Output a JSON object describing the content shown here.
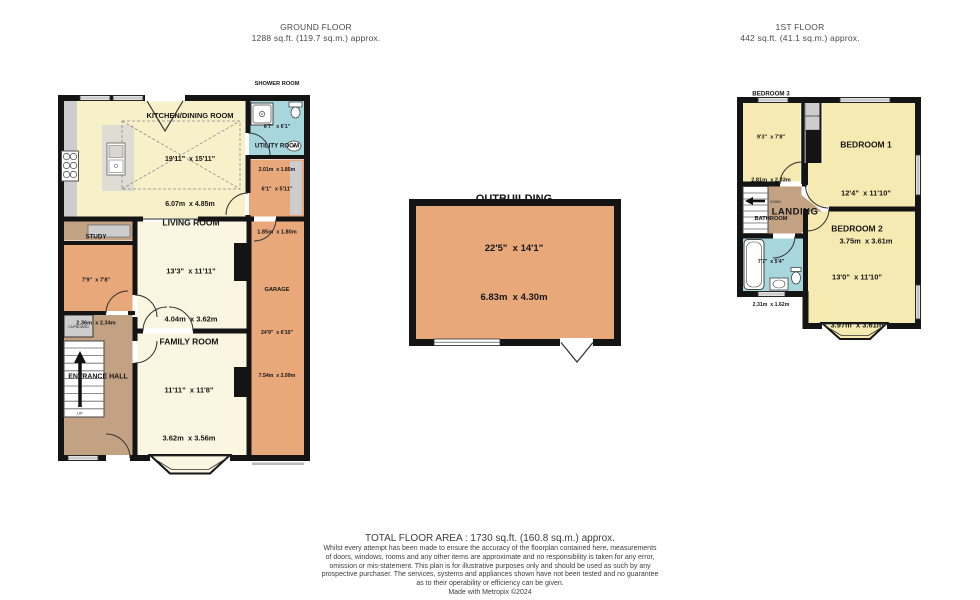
{
  "ground_floor": {
    "title": "GROUND FLOOR",
    "area": "1288 sq.ft. (119.7 sq.m.) approx.",
    "rooms": {
      "kitchen": {
        "name": "KITCHEN/DINING ROOM",
        "imperial": "19'11\"  x 15'11\"",
        "metric": "6.07m  x 4.85m"
      },
      "shower": {
        "name": "SHOWER ROOM",
        "imperial": "6'7\"  x 6'1\"",
        "metric": "2.01m  x 1.85m"
      },
      "utility": {
        "name": "UTILITY ROOM",
        "imperial": "6'1\"  x 5'11\"",
        "metric": "1.85m  x 1.80m"
      },
      "garage": {
        "name": "GARAGE",
        "imperial": "24'9\"  x 6'10\"",
        "metric": "7.54m  x 2.09m"
      },
      "living": {
        "name": "LIVING ROOM",
        "imperial": "13'3\"  x 11'11\"",
        "metric": "4.04m  x 3.62m"
      },
      "study": {
        "name": "STUDY",
        "imperial": "7'9\"  x 7'8\"",
        "metric": "2.36m  x 2.34m"
      },
      "family": {
        "name": "FAMILY ROOM",
        "imperial": "11'11\"  x 11'8\"",
        "metric": "3.62m  x 3.56m"
      },
      "hall": {
        "name": "ENTRANCE HALL"
      },
      "cupboard": {
        "name": "CUPBOARD"
      },
      "up_label": "UP"
    }
  },
  "outbuilding": {
    "name": "OUTBUILDING",
    "imperial": "22'5\"  x 14'1\"",
    "metric": "6.83m  x 4.30m"
  },
  "first_floor": {
    "title": "1ST FLOOR",
    "area": "442 sq.ft. (41.1 sq.m.) approx.",
    "rooms": {
      "bedroom1": {
        "name": "BEDROOM 1",
        "imperial": "12'4\"  x 11'10\"",
        "metric": "3.75m  x 3.61m"
      },
      "bedroom2": {
        "name": "BEDROOM 2",
        "imperial": "13'0\"  x 11'10\"",
        "metric": "3.97m  x 3.61m"
      },
      "bedroom3": {
        "name": "BEDROOM 3",
        "imperial": "9'3\"  x 7'8\"",
        "metric": "2.81m  x 2.33m"
      },
      "bathroom": {
        "name": "BATHROOM",
        "imperial": "7'7\"  x 5'4\"",
        "metric": "2.31m  x 1.62m"
      },
      "landing": {
        "name": "LANDING"
      },
      "wardrobe": {
        "name": "WARDROBE"
      },
      "down_label": "DOWN"
    }
  },
  "footer": {
    "total": "TOTAL FLOOR AREA : 1730 sq.ft. (160.8 sq.m.) approx.",
    "disclaimer_lines": [
      "Whilst every attempt has been made to ensure the accuracy of the floorplan contained here, measurements",
      "of doors, windows, rooms and any other items are approximate and no responsibility is taken for any error,",
      "omission or mis-statement. This plan is for illustrative purposes only and should be used as such by any",
      "prospective purchaser. The services, systems and appliances shown have not been tested and no guarantee",
      "as to their operability or efficiency can be given.",
      "Made with Metropix ©2024"
    ]
  },
  "colors": {
    "wall": "#141414",
    "room_yellow": "#F5EAB2",
    "room_cream": "#FAF6E2",
    "room_pale_yellow": "#F7F0C9",
    "room_orange": "#E8A87A",
    "room_tan": "#C3A284",
    "room_blue": "#A7D6DD",
    "fixture_gray": "#CDCDCD"
  }
}
